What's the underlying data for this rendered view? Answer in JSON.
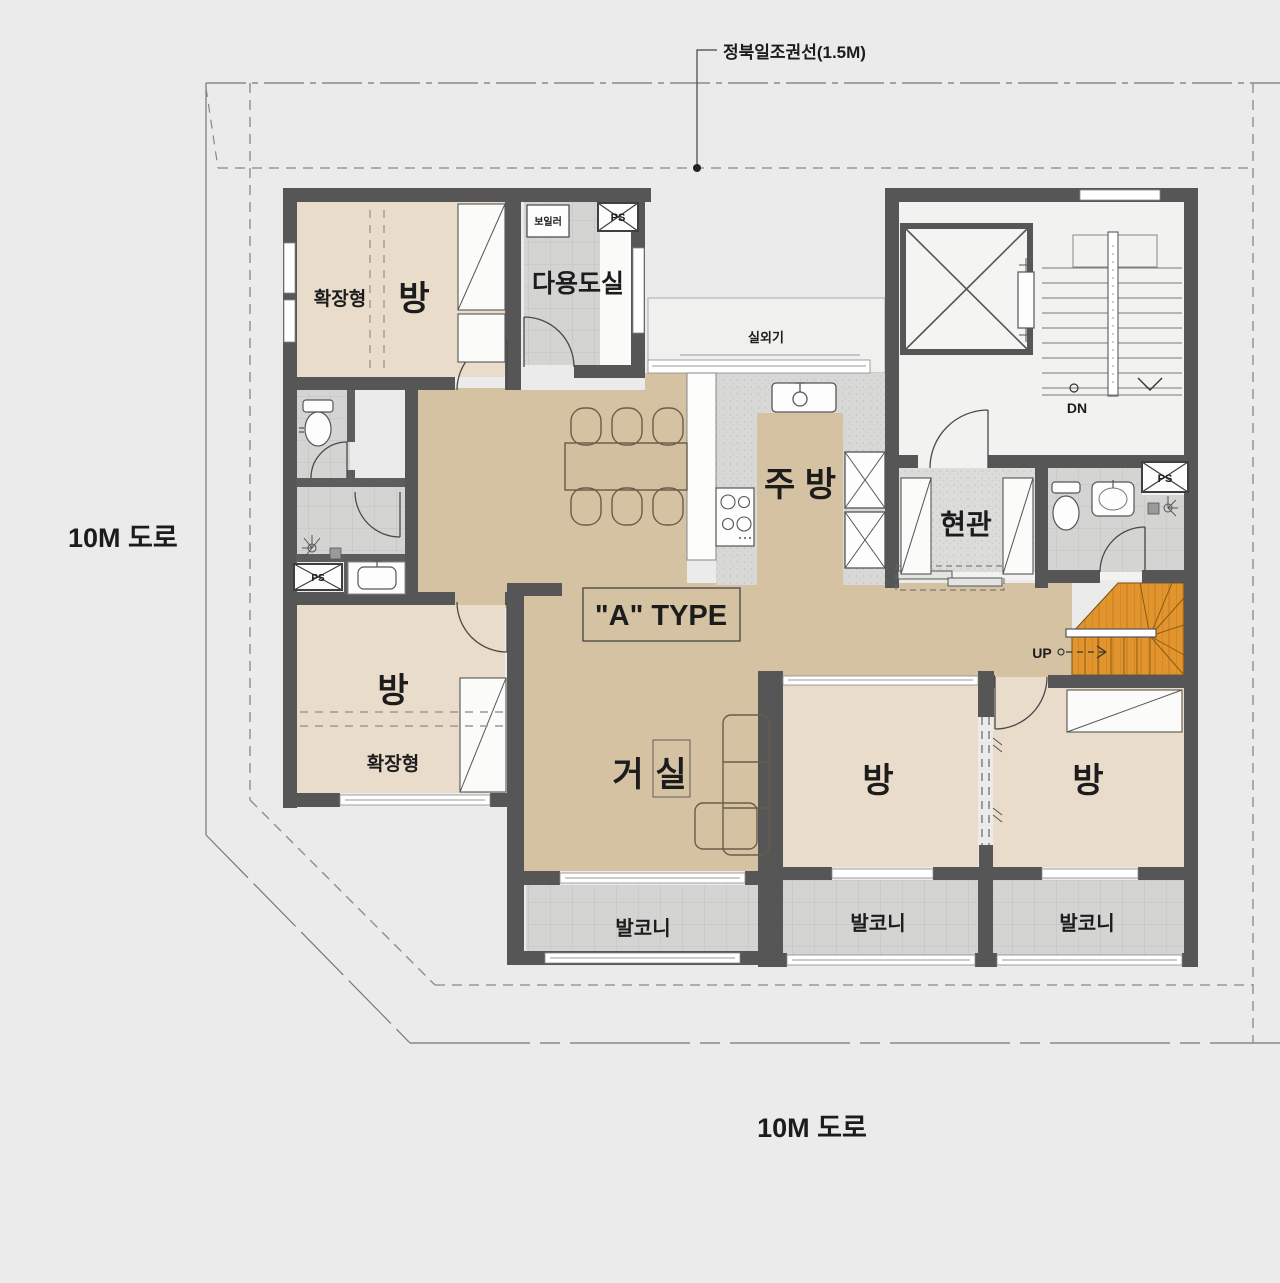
{
  "colors": {
    "background": "#ebebeb",
    "wall": "#565656",
    "floor_wood": "#d5c2a3",
    "floor_room": "#e9dcca",
    "floor_tile": "#d4d4d3",
    "floor_white": "#f2f2f1",
    "stair_wood": "#e2952f"
  },
  "site": {
    "sun_line_label": "정북일조권선(1.5M)",
    "road_left": "10M 도로",
    "road_bottom": "10M 도로"
  },
  "unit": {
    "type_label": "\"A\" TYPE"
  },
  "rooms": {
    "bedroom_top_left": {
      "name": "방",
      "tag": "확장형"
    },
    "bedroom_mid_left": {
      "name": "방",
      "tag": "확장형"
    },
    "bedroom_bottom_1": {
      "name": "방"
    },
    "bedroom_bottom_2": {
      "name": "방"
    },
    "living": {
      "name_1": "거",
      "name_2": "실"
    },
    "kitchen": {
      "name": "주 방"
    },
    "entry": {
      "name": "현관"
    },
    "utility": {
      "name": "다용도실",
      "boiler": "보일러"
    },
    "outdoor_unit": {
      "name": "실외기"
    },
    "balcony_1": {
      "name": "발코니"
    },
    "balcony_2": {
      "name": "발코니"
    },
    "balcony_3": {
      "name": "발코니"
    }
  },
  "stairs": {
    "common_down": "DN",
    "internal_up": "UP"
  },
  "shafts": {
    "ps_top": "PS",
    "ps_left": "PS",
    "ps_right": "PS"
  }
}
